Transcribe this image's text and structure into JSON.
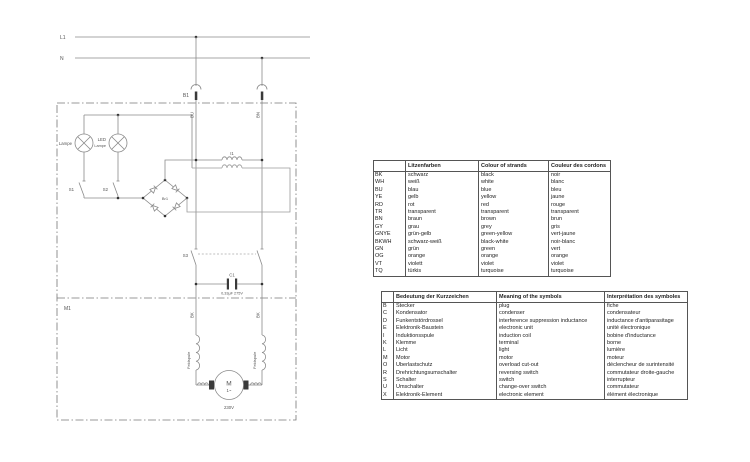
{
  "diagram": {
    "l1_label": "L1",
    "n_label": "N",
    "plug_label": "B1",
    "wire_bu": "BU",
    "wire_bn": "BN",
    "lamp_label": "Lampe",
    "led_label_1": "LED",
    "led_label_2": "Lampe",
    "s1_label": "S1",
    "s2_label": "S2",
    "bridge_label": "Br1",
    "choke_label": "I1",
    "s3_label": "S3",
    "cap_label": "C1",
    "cap_value": "0,33µF 275V",
    "module_label": "M1",
    "wire_bk_left": "BK",
    "wire_bk_right": "BK",
    "field_coil_left": "Feldspule",
    "field_coil_right": "Feldspule",
    "motor_letter": "M",
    "motor_phase": "1~",
    "motor_voltage": "230V"
  },
  "color_table": {
    "headers": {
      "code": "",
      "de": "Litzenfarben",
      "en": "Colour of strands",
      "fr": "Couleur des cordons"
    },
    "rows": [
      {
        "code": "BK",
        "de": "schwarz",
        "en": "black",
        "fr": "noir"
      },
      {
        "code": "WH",
        "de": "weiß",
        "en": "white",
        "fr": "blanc"
      },
      {
        "code": "BU",
        "de": "blau",
        "en": "blue",
        "fr": "bleu"
      },
      {
        "code": "YE",
        "de": "gelb",
        "en": "yellow",
        "fr": "jaune"
      },
      {
        "code": "RD",
        "de": "rot",
        "en": "red",
        "fr": "rouge"
      },
      {
        "code": "TR",
        "de": "transparent",
        "en": "transparent",
        "fr": "transparent"
      },
      {
        "code": "BN",
        "de": "braun",
        "en": "brown",
        "fr": "brun"
      },
      {
        "code": "GY",
        "de": "grau",
        "en": "grey",
        "fr": "gris"
      },
      {
        "code": "GNYE",
        "de": "grün-gelb",
        "en": "green-yellow",
        "fr": "vert-jaune"
      },
      {
        "code": "BKWH",
        "de": "schwarz-weiß",
        "en": "black-white",
        "fr": "noir-blanc"
      },
      {
        "code": "GN",
        "de": "grün",
        "en": "green",
        "fr": "vert"
      },
      {
        "code": "OG",
        "de": "orange",
        "en": "orange",
        "fr": "orange"
      },
      {
        "code": "VT",
        "de": "violett",
        "en": "violet",
        "fr": "violet"
      },
      {
        "code": "TQ",
        "de": "türkis",
        "en": "turquoise",
        "fr": "turquoise"
      }
    ]
  },
  "symbol_table": {
    "headers": {
      "code": "",
      "de": "Bedeutung der Kurzzeichen",
      "en": "Meaning of the symbols",
      "fr": "Interprétation des symboles"
    },
    "rows": [
      {
        "code": "B",
        "de": "Stecker",
        "en": "plug",
        "fr": "fiche"
      },
      {
        "code": "C",
        "de": "Kondensator",
        "en": "condenser",
        "fr": "condensateur"
      },
      {
        "code": "D",
        "de": "Funkentstördrossel",
        "en": "interference suppression inductance",
        "fr": "inductance d'antiparasitage"
      },
      {
        "code": "E",
        "de": "Elektronik-Baustein",
        "en": "electronic unit",
        "fr": "unité électronique"
      },
      {
        "code": "I",
        "de": "Induktionsspule",
        "en": "induction coil",
        "fr": "bobine d'inductance"
      },
      {
        "code": "K",
        "de": "Klemme",
        "en": "terminal",
        "fr": "borne"
      },
      {
        "code": "L",
        "de": "Licht",
        "en": "light",
        "fr": "lumière"
      },
      {
        "code": "M",
        "de": "Motor",
        "en": "motor",
        "fr": "moteur"
      },
      {
        "code": "O",
        "de": "Überlastschutz",
        "en": "overload cut-out",
        "fr": "déclencheur de surintensité"
      },
      {
        "code": "R",
        "de": "Drehrichtungsumschalter",
        "en": "reversing switch",
        "fr": "commutateur droite-gauche"
      },
      {
        "code": "S",
        "de": "Schalter",
        "en": "switch",
        "fr": "interrupteur"
      },
      {
        "code": "U",
        "de": "Umschalter",
        "en": "change-over switch",
        "fr": "commutateur"
      },
      {
        "code": "X",
        "de": "Elektronik-Element",
        "en": "electronic element",
        "fr": "élément électronique"
      }
    ]
  }
}
